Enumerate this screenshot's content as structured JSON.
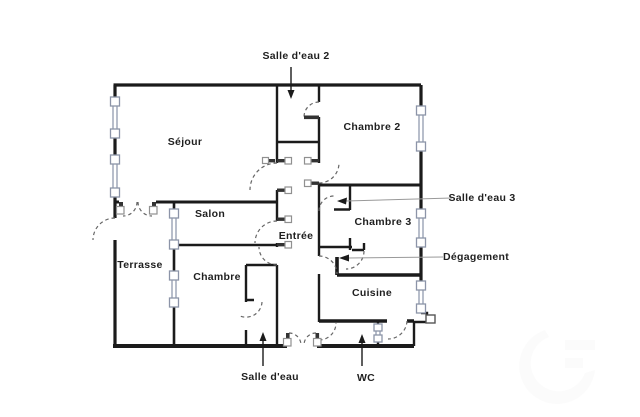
{
  "image_type": "apartment floor plan",
  "rooms": {
    "sejour": "Séjour",
    "chambre2": "Chambre 2",
    "salon": "Salon",
    "chambre3": "Chambre 3",
    "entree": "Entrée",
    "terrasse": "Terrasse",
    "chambre": "Chambre",
    "cuisine": "Cuisine"
  },
  "annotations": {
    "salle_deau_2": "Salle d'eau 2",
    "salle_deau_3": "Salle d'eau 3",
    "degagement": "Dégagement",
    "salle_deau": "Salle d'eau",
    "wc": "WC"
  },
  "colors": {
    "wall": "#1b1b1b",
    "window": "#9aa3b5",
    "door_arc": "#666666",
    "pointer_line": "#999999",
    "label_text": "#1f1f1f",
    "background": "#ffffff"
  }
}
